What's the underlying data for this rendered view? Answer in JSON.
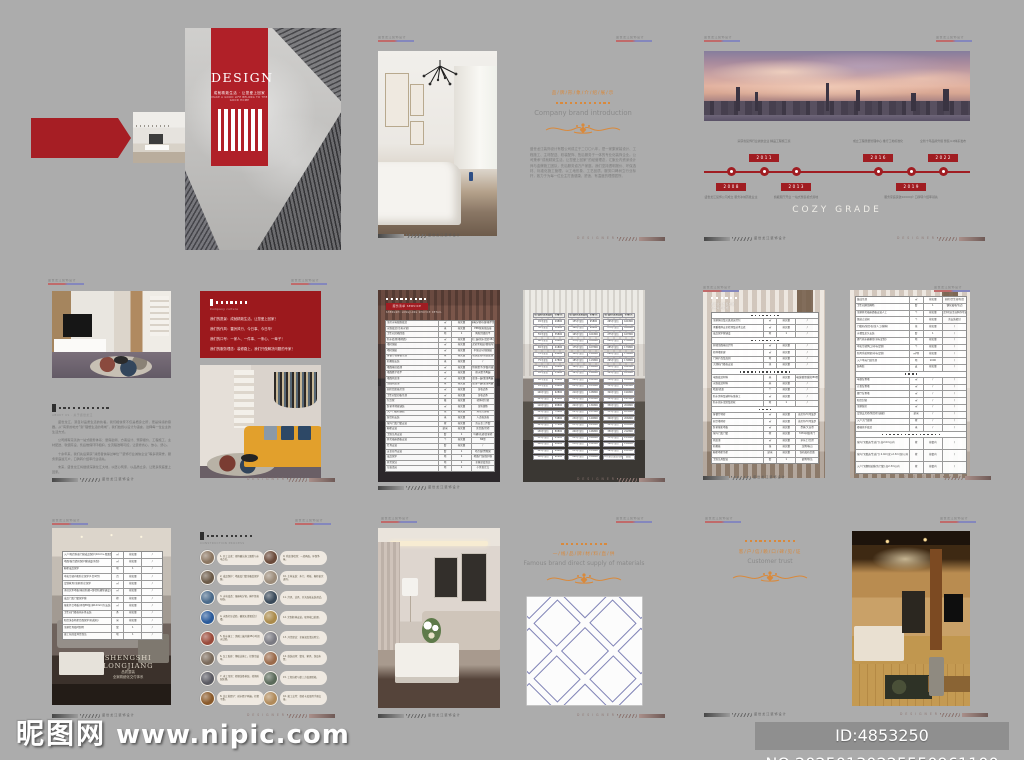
{
  "page": {
    "bg": "#acacac"
  },
  "colors": {
    "red": "#a61e24",
    "banner_red": "#b02028",
    "box_red": "#9c191d",
    "orange": "#d9893b"
  },
  "watermark": {
    "logo": "昵图网",
    "url": "www.nipic.com",
    "id_text": "ID:4853250 NO:20250130225550961100"
  },
  "marks": {
    "header_text": "盛世龙江装饰设计",
    "footer_left_text": "盛世龙江装饰设计",
    "footer_right_text": "D E S I G N E R"
  },
  "cover": {
    "title": "DESIGN",
    "subtitle": "成就精致生活 · 让您爱上回家",
    "subtitle_en": "MAKE A GOOD LIFE BELONG TO THE GOOD HOME"
  },
  "brand_intro": {
    "title_cn": "品/牌/形/象/介/绍/展/示",
    "title_en": "Company brand introduction",
    "paragraph": "盛世龙江装饰设计有限公司成立于二〇〇八年，是一家集家装设计、工程施工、主材配送、软装配饰、售后服务于一体的专业化装饰企业。公司秉承“成就精致生活，让您爱上回家”的经营理念，汇聚业内资深设计师与金牌施工团队，先后服务逾万户家庭。我们坚持透明报价、环保选材、标准化施工管理，以工地形象、工艺品质、服务口碑树立行业标杆，致力于为每一位业主打造健康、舒适、有温度的理想居所。"
  },
  "milestones": {
    "caption": "COZY GRADE",
    "items": [
      {
        "year": "2008",
        "label": "盛世龙江装饰公司成立 服务冰城首批业主"
      },
      {
        "year": "2011",
        "label": "荣获省装饰行业诚信企业 精品工程施工奖"
      },
      {
        "year": "2013",
        "label": "旗舰展厅开业 一站式整装模式落地"
      },
      {
        "year": "2016",
        "label": "成立工程质量管理中心 推行工地标准化"
      },
      {
        "year": "2019",
        "label": "服务家庭突破10000户 口碑转介绍率领先"
      },
      {
        "year": "2022",
        "label": "全新十年品牌升级 整装4.0体系发布"
      }
    ]
  },
  "about": {
    "title_en": "ABOUT US · 关于盛世龙江",
    "paragraphs": [
      "盛世龙江，源自对品质生活的执着。我们相信家不仅是栖身之所，更是情感的容器。从“有家的地方”到“理想生活的场域”，我们始终以设计为语言，诠释每一位业主的生活方式。",
      "公司拥有完善的一站式服务体系：量房勘测、方案设计、预算报价、工程施工、主材配送、软装陈设、售后维保环环相扣，全流程透明可控，让装修省心、放心、舒心。",
      "十余年来，我们先后荣获“消费者信得过单位”“装饰行业诚信企业”等多项荣誉，服务家庭逾万户，口碑转介绍率行业领先。",
      "未来，盛世龙江将继续深耕龙江大地，以匠心筑家，以品质立身，让更多家庭爱上回家。"
    ]
  },
  "culture": {
    "title_en": "Company culture",
    "lines": [
      "我们的愿景：成就精致生活，让您爱上回家！",
      "我们的作风：雷厉风行、今日事、今日毕！",
      "我们的口号：一家人、一件事、一条心、一辈子！",
      "我们的服务理念：装修路上，我们只做解决问题的专家！"
    ]
  },
  "service_table": {
    "tag": "服务清单 SERVICE",
    "sub": "SHENGSHI LONGJIANG SERVICE DETAIL",
    "rows": [
      [
        "全房水电线路改造",
        "㎡",
        "按实量",
        "强弱电分管布线/横平竖直"
      ],
      [
        "水路改造(冷热水管)",
        "米",
        "按实量",
        "PPR管热熔连接"
      ],
      [
        "卫生间沉箱回填",
        "项",
        "1",
        "陶粒回填找平"
      ],
      [
        "防水处理(墙地面)",
        "㎡",
        "按实量",
        "涂刷三遍/闭水试验48小时"
      ],
      [
        "墙砖铺贴",
        "㎡",
        "按实量",
        "水泥砂浆粘贴/留缝均匀"
      ],
      [
        "地砖铺贴",
        "㎡",
        "按实量",
        "干铺法/对缝铺贴"
      ],
      [
        "客餐厅石膏板吊顶",
        "㎡",
        "按实量",
        "轻钢龙骨/防裂处理"
      ],
      [
        "石膏线安装",
        "米",
        "按实量",
        "/"
      ],
      [
        "墙面基层处理",
        "㎡",
        "按实量",
        "铲除原腻子/界面剂滚涂"
      ],
      [
        "墙面腻子找平",
        "㎡",
        "按实量",
        "耐水腻子两遍"
      ],
      [
        "墙面乳胶漆",
        "㎡",
        "按实量",
        "底漆一遍/面漆两遍"
      ],
      [
        "顶面乳胶漆",
        "㎡",
        "按实量",
        "底漆一遍/面漆两遍"
      ],
      [
        "厨房铝扣板吊顶",
        "㎡",
        "按实量",
        "含收边条"
      ],
      [
        "卫生间铝扣板吊顶",
        "㎡",
        "按实量",
        "含收边条"
      ],
      [
        "包立管",
        "根",
        "按实量",
        "轻体砖包管"
      ],
      [
        "卧室木地板铺装",
        "㎡",
        "按实量",
        "含防潮垫"
      ],
      [
        "入户门槛石铺贴",
        "块",
        "按实量",
        "天然大理石"
      ],
      [
        "窗台石安装",
        "米",
        "按实量",
        "人造石英石"
      ],
      [
        "室内门及门套安装",
        "樘",
        "按实量",
        "含五金三件套"
      ],
      [
        "橱柜安装",
        "延米",
        "按实量",
        "含台面/吊柜"
      ],
      [
        "卫浴洁具安装",
        "套",
        "1",
        "马桶/花洒/浴室柜"
      ],
      [
        "开关插座面板安装",
        "个",
        "按实量",
        "86型"
      ],
      [
        "灯具安装",
        "套",
        "按实量",
        "/"
      ],
      [
        "五金挂件安装",
        "套",
        "1",
        "毛巾架/置物架"
      ],
      [
        "成品保护",
        "项",
        "1",
        "地面/门窗保护膜"
      ],
      [
        "开荒保洁",
        "项",
        "1",
        "全屋深度清洁"
      ],
      [
        "垃圾清运",
        "项",
        "1",
        "小区指定点"
      ]
    ]
  },
  "package_table": {
    "headers": [
      "户型/面积(建筑面积)",
      "价格/元"
    ],
    "cols": [
      [
        [
          "45平全包",
          "29800"
        ],
        [
          "50平全包",
          "32800"
        ],
        [
          "55平全包",
          "35800"
        ],
        [
          "60平全包",
          "38800"
        ],
        [
          "65平全包",
          "41800"
        ],
        [
          "70平全包",
          "44800"
        ],
        [
          "75平全包",
          "47800"
        ],
        [
          "80平全包",
          "50800"
        ],
        [
          "85平全包",
          "53800"
        ],
        [
          "90平全包",
          "56800"
        ],
        [
          "95平全包",
          "59800"
        ],
        [
          "100平全包",
          "62800"
        ],
        [
          "105平全包",
          "65800"
        ],
        [
          "110平全包",
          "68800"
        ],
        [
          "115平全包",
          "71800"
        ],
        [
          "120平全包",
          "74800"
        ],
        [
          "125平全包",
          "77800"
        ],
        [
          "130平全包",
          "80800"
        ],
        [
          "135平全包",
          "83800"
        ],
        [
          "140平全包",
          "86800"
        ],
        [
          "145平全包",
          "89800"
        ],
        [
          "150平全包",
          "92800"
        ]
      ],
      [
        [
          "155平全包",
          "95800"
        ],
        [
          "160平全包",
          "98800"
        ],
        [
          "165平全包",
          "101800"
        ],
        [
          "170平全包",
          "104800"
        ],
        [
          "175平全包",
          "107800"
        ],
        [
          "180平全包",
          "110800"
        ],
        [
          "185平全包",
          "113800"
        ],
        [
          "190平全包",
          "116800"
        ],
        [
          "195平全包",
          "119800"
        ],
        [
          "200平全包",
          "122800"
        ],
        [
          "205平全包",
          "125800"
        ],
        [
          "210平全包",
          "128800"
        ],
        [
          "215平全包",
          "131800"
        ],
        [
          "220平全包",
          "134800"
        ],
        [
          "225平全包",
          "137800"
        ],
        [
          "230平全包",
          "140800"
        ],
        [
          "235平全包",
          "143800"
        ],
        [
          "240平全包",
          "146800"
        ],
        [
          "245平全包",
          "149800"
        ],
        [
          "250平全包",
          "152800"
        ],
        [
          "255平全包",
          "155800"
        ],
        [
          "260平全包",
          "158800"
        ]
      ],
      [
        [
          "265平全包",
          "161800"
        ],
        [
          "270平全包",
          "164800"
        ],
        [
          "275平全包",
          "167800"
        ],
        [
          "280平全包",
          "170800"
        ],
        [
          "285平全包",
          "173800"
        ],
        [
          "290平全包",
          "176800"
        ],
        [
          "295平全包",
          "179800"
        ],
        [
          "300平全包",
          "182800"
        ],
        [
          "305平全包",
          "185800"
        ],
        [
          "310平全包",
          "188800"
        ],
        [
          "315平全包",
          "191800"
        ],
        [
          "320平全包",
          "194800"
        ],
        [
          "325平全包",
          "197800"
        ],
        [
          "330平全包",
          "200800"
        ],
        [
          "335平全包",
          "203800"
        ],
        [
          "340平全包",
          "206800"
        ],
        [
          "345平全包",
          "209800"
        ],
        [
          "350平全包",
          "212800"
        ],
        [
          "355平全包",
          "215800"
        ],
        [
          "360平全包",
          "218800"
        ],
        [
          "365平全包",
          "221800"
        ],
        [
          "370平全包(复式/别墅)",
          "面议"
        ]
      ]
    ]
  },
  "quote_table_a": {
    "head_lines": [
      "盛世龙江整装套餐",
      "包含项目明细"
    ],
    "rows": [
      {
        "sec": 8
      },
      {
        "c": [
          "全屋拆旧及垃圾清运打包",
          "㎡",
          "按实量",
          "/"
        ]
      },
      {
        "c": [
          "承重墙体安全检测及技术交底",
          "㎡",
          "按实量",
          "/"
        ]
      },
      {
        "c": [
          "成品保护膜铺设",
          "项",
          "1",
          "/"
        ]
      },
      {
        "sec": 8
      },
      {
        "c": [
          "原墙顶面基层铲除",
          "㎡",
          "按实量",
          "/"
        ]
      },
      {
        "c": [
          "轻体墙新建",
          "㎡",
          "按实量",
          "/"
        ]
      },
      {
        "c": [
          "门洞扩改及加固",
          "项",
          "按实量",
          "/"
        ]
      },
      {
        "c": [
          "大理石门槛石安装",
          "块",
          "按实量",
          "/"
        ]
      },
      {
        "sec": 14
      },
      {
        "c": [
          "电路改造材料",
          "米",
          "按实量",
          "津成电线/联塑线管/86型底盒"
        ]
      },
      {
        "c": [
          "水路改造材料",
          "米",
          "按实量",
          "/"
        ]
      },
      {
        "c": [
          "暗盒/底盒",
          "个",
          "按实量",
          "/"
        ]
      },
      {
        "c": [
          "防水涂料及辅材标准施工",
          "㎡",
          "按实量",
          "/"
        ]
      },
      {
        "c": [
          "防水闭水试验及验收",
          "项",
          "1",
          "/"
        ]
      },
      {
        "sec": 4
      },
      {
        "c": [
          "客餐厅地砖",
          "㎡",
          "按实量",
          "诺贝尔/马可波罗"
        ]
      },
      {
        "c": [
          "厨卫墙地砖",
          "㎡",
          "按实量",
          "诺贝尔/马可波罗"
        ]
      },
      {
        "c": [
          "卧室强化地板",
          "㎡",
          "按实量",
          "圣象/大自然"
        ]
      },
      {
        "c": [
          "室内门及门套",
          "樘",
          "按实量",
          "TATA同级木门"
        ]
      },
      {
        "c": [
          "乳胶漆",
          "㎡",
          "按实量",
          "多乐士/立邦"
        ]
      },
      {
        "c": [
          "石膏板",
          "张",
          "按实量",
          "龙牌/泰山"
        ]
      },
      {
        "c": [
          "橱柜地柜吊柜",
          "延米",
          "按实量",
          "含石英石台面"
        ]
      },
      {
        "c": [
          "卫浴洁具套装",
          "套",
          "1",
          "箭牌/恒洁"
        ]
      }
    ]
  },
  "quote_table_b": {
    "rows": [
      {
        "c": [
          "集成吊顶",
          "㎡",
          "按实量",
          "厨房/卫生间/阳台"
        ]
      },
      {
        "c": [
          "卫生间淋浴隔断",
          "套",
          "1",
          "钢化玻璃/包边"
        ]
      },
      {
        "c": [
          "全屋开关插座面板安装人工",
          "个",
          "按实量",
          "不含主材(业主自购亦可安装)"
        ]
      },
      {
        "c": [
          "烟道止逆阀",
          "个",
          "按实量",
          "含安装密封"
        ]
      },
      {
        "c": [
          "门槛石/窗台石(含人工/辅料)",
          "块",
          "按实量",
          "/"
        ]
      },
      {
        "c": [
          "水槽及龙头安装",
          "套",
          "1",
          "/"
        ]
      },
      {
        "c": [
          "燃气热水器移位(非标定制)",
          "项",
          "按实量",
          "/"
        ]
      },
      {
        "c": [
          "中央空调风口(非标定制)",
          "个",
          "按实量",
          "/"
        ]
      },
      {
        "c": [
          "新风系统预留(非标定制)",
          "㎡/项",
          "按实量",
          "/"
        ]
      },
      {
        "c": [
          "入户单元门处吊顶",
          "项",
          "1000",
          "/"
        ]
      },
      {
        "c": [
          "结构胶",
          "支",
          "按实量",
          "/"
        ]
      },
      {
        "sec": 4
      },
      {
        "c": [
          "电视背景墙",
          "㎡",
          "/",
          "/"
        ]
      },
      {
        "c": [
          "沙发背景墙",
          "㎡",
          "/",
          "/"
        ]
      },
      {
        "c": [
          "餐厅背景墙",
          "㎡",
          "/",
          "/"
        ]
      },
      {
        "c": [
          "阳台封窗",
          "㎡",
          "/",
          "/"
        ]
      },
      {
        "c": [
          "全屋窗帘",
          "㎡",
          "/",
          "/"
        ]
      },
      {
        "c": [
          "定制玄关柜/阳台柜(选配)",
          "延米",
          "/",
          "/"
        ]
      },
      {
        "c": [
          "入户大门更换",
          "樘",
          "/",
          "/"
        ]
      },
      {
        "c": [
          "楼梯扶手改造",
          "米",
          "/",
          "/"
        ]
      },
      {
        "sec": 16
      },
      {
        "tall": [
          "室内门(赠送/生态门) 高2.0m以内",
          "樘",
          "按套内",
          "/"
        ]
      },
      {
        "tall": [
          "室内门(赠送/生态门) 2.0m(含)-2.3m(含)以内",
          "樘",
          "按套内",
          "/"
        ]
      },
      {
        "tall": [
          "入户门(翻新贴膜/含门套) 高2.3m以内",
          "樘",
          "按套内",
          "/"
        ]
      }
    ]
  },
  "protect_table": {
    "rows": [
      [
        "入户/阳台防盗门窗成品保护(10cm+双面保护膜)",
        "㎡",
        "按实量",
        "/"
      ],
      [
        "地面/窗台瓷砖保护膜铺设(防刮)",
        "㎡",
        "按实量",
        "/"
      ],
      [
        "橱柜成品保护",
        "项",
        "1",
        "/"
      ],
      [
        "中央空调内机防尘保护(1台/2匹)",
        "台",
        "按实量",
        "/"
      ],
      [
        "定制家具(全屋)防尘保护",
        "㎡",
        "按实量",
        "/"
      ],
      [
        "多层实木地板(基层防潮+静音防潮垫铺设)",
        "㎡",
        "按实量",
        "/"
      ],
      [
        "成品门及门套保护膜",
        "樘",
        "按实量",
        "/"
      ],
      [
        "强化复合地板(环保E0级 厚12mm)包安装",
        "㎡",
        "按实量",
        "/"
      ],
      [
        "卫生间门槛石挡水条安装",
        "条",
        "按实量",
        "/"
      ],
      [
        "阳台洗衣机柜台面保护(石英石)",
        "米",
        "按实量",
        "/"
      ],
      [
        "全屋灯具临时照明",
        "套",
        "1",
        "/"
      ],
      [
        "竣工前深度开荒保洁",
        "项",
        "1",
        "/"
      ]
    ]
  },
  "showcase": {
    "brand": "SHENGSHI LONGJIANG",
    "sub1": "品质整装",
    "sub2": "全案精细化交付体系",
    "sub3": "SHENGSHI LONGJIANG DECORATION DESIGN"
  },
  "process": {
    "title_en": "CONSTRUCTION PROCESS",
    "items": [
      {
        "text": "1. 开工交底：现场确认施工图纸与水电点位。",
        "color": "#8a7560"
      },
      {
        "text": "2. 成品保护：地面及门窗全覆盖保护膜。",
        "color": "#6b5a48"
      },
      {
        "text": "3. 水电改造：强弱电分管，横平竖直布线。",
        "color": "#4a6a8a"
      },
      {
        "text": "4. 水路打压试验，确保无渗漏后封槽。",
        "color": "#2a5a9a"
      },
      {
        "text": "5. 防水施工：涂刷三遍并做48小时闭水试验。",
        "color": "#9a4a3a"
      },
      {
        "text": "6. 瓦工贴砖：薄贴法施工，控制空鼓率。",
        "color": "#7a6a5a"
      },
      {
        "text": "7. 木工吊顶：轻钢龙骨基层，转角防裂处理。",
        "color": "#5a5a62"
      },
      {
        "text": "8. 油工批腻子：耐水腻子两遍，打磨平整。",
        "color": "#8a5a2a"
      },
      {
        "text": "9. 乳胶漆喷涂：一底两面，环保净味。",
        "color": "#6a4a3a"
      },
      {
        "text": "10. 主材安装：木门、地板、橱柜依次进场。",
        "color": "#9a8a78"
      },
      {
        "text": "11. 灯具、洁具、开关面板安装调试。",
        "color": "#3a4a5a"
      },
      {
        "text": "12. 定制柜体安装，现场收口处理。",
        "color": "#aa8a4a"
      },
      {
        "text": "13. 开荒保洁：全屋深度清洁除尘。",
        "color": "#7a7a82"
      },
      {
        "text": "14. 软装进场：窗帘、家具、饰品布置。",
        "color": "#9a6a4a"
      },
      {
        "text": "15. 工程自检与第三方监理验收。",
        "color": "#5a6a5a"
      },
      {
        "text": "16. 竣工交付：保修卡及使用手册交接。",
        "color": "#b08a5a"
      }
    ]
  },
  "materials": {
    "title_cn": "一/线/品/牌/材/料/直/供",
    "title_en": "Famous brand direct supply of materials"
  },
  "customer": {
    "title_cn": "客/户/信/赖/口/碑/见/证",
    "title_en": "Customer trust"
  }
}
